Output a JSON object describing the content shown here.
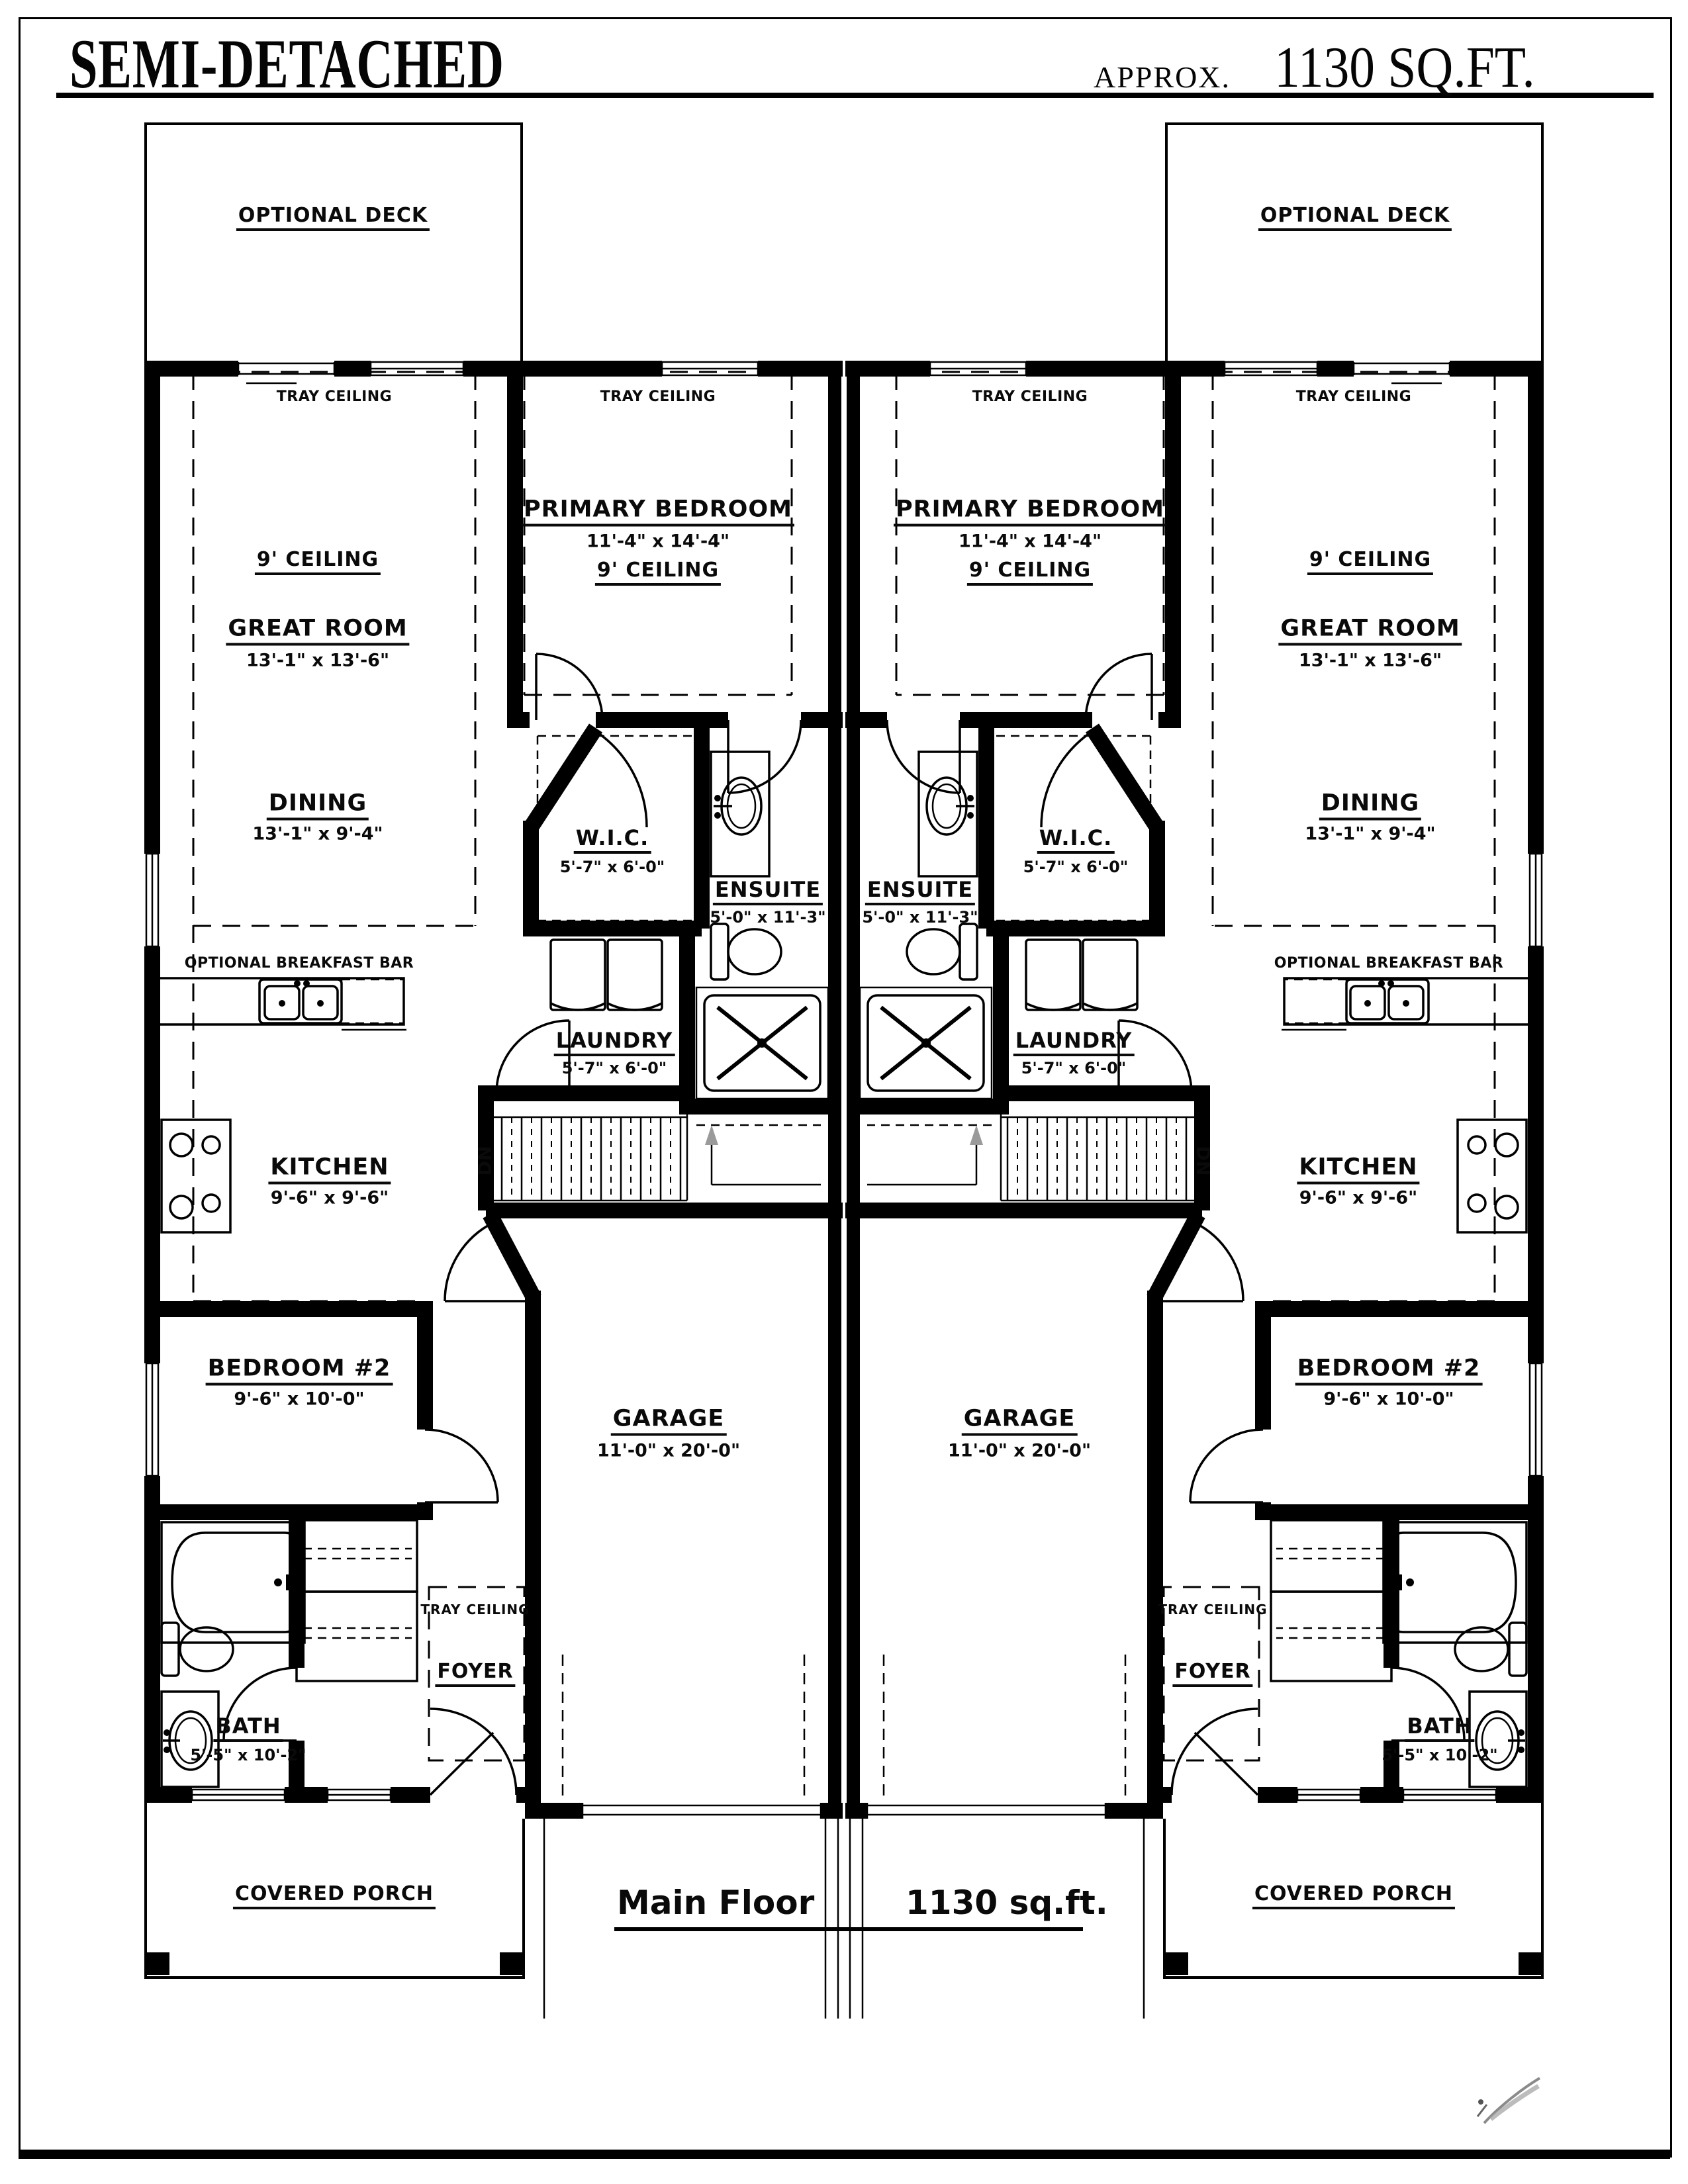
{
  "header": {
    "title": "SEMI-DETACHED",
    "approx": "APPROX.",
    "area": "1130 SQ.FT."
  },
  "plan": {
    "deck": "OPTIONAL DECK",
    "tray": "TRAY CEILING",
    "ceiling9": "9' CEILING",
    "dn": "DN",
    "breakfast_bar": "OPTIONAL BREAKFAST BAR",
    "rooms": {
      "great": {
        "name": "GREAT ROOM",
        "dims": "13'-1\" x 13'-6\""
      },
      "dining": {
        "name": "DINING",
        "dims": "13'-1\" x 9'-4\""
      },
      "primary": {
        "name": "PRIMARY BEDROOM",
        "dims": "11'-4\" x 14'-4\""
      },
      "wic": {
        "name": "W.I.C.",
        "dims": "5'-7\" x 6'-0\""
      },
      "ensuite": {
        "name": "ENSUITE",
        "dims": "5'-0\" x 11'-3\""
      },
      "laundry": {
        "name": "LAUNDRY",
        "dims": "5'-7\" x 6'-0\""
      },
      "kitchen": {
        "name": "KITCHEN",
        "dims": "9'-6\" x 9'-6\""
      },
      "bedroom2": {
        "name": "BEDROOM #2",
        "dims": "9'-6\" x 10'-0\""
      },
      "garage": {
        "name": "GARAGE",
        "dims": "11'-0\" x 20'-0\""
      },
      "bath": {
        "name": "BATH",
        "dims": "5'-5\" x 10'-2\""
      },
      "foyer": {
        "name": "FOYER"
      },
      "porch": {
        "name": "COVERED PORCH"
      }
    }
  },
  "footer": {
    "floor": "Main Floor",
    "area": "1130 sq.ft."
  },
  "colors": {
    "line": "#000000",
    "arrow_gray": "#9a9a9a",
    "signature_gray": "#8a8a8a"
  }
}
